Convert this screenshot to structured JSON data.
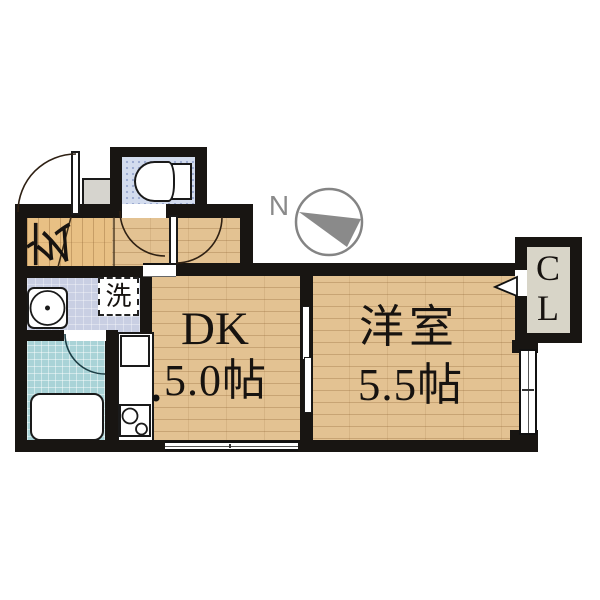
{
  "plan": {
    "title": "1DK apartment floor plan",
    "compass": {
      "label": "N"
    },
    "labels": {
      "entrance": "玄",
      "laundry": "洗",
      "dk_name": "DK",
      "dk_size": "5.0帖",
      "western_name": "洋室",
      "western_size": "5.5帖",
      "closet_line1": "C",
      "closet_line2": "L"
    },
    "colors": {
      "wall": "#181512",
      "wood": "#e3c292",
      "washroom_floor": "#c9cfe3",
      "bathroom_floor": "#a9d3d7",
      "toilet_floor": "#d3dcee",
      "closet_floor": "#d8d5c8",
      "compass_gray": "#8a8a8a"
    }
  }
}
